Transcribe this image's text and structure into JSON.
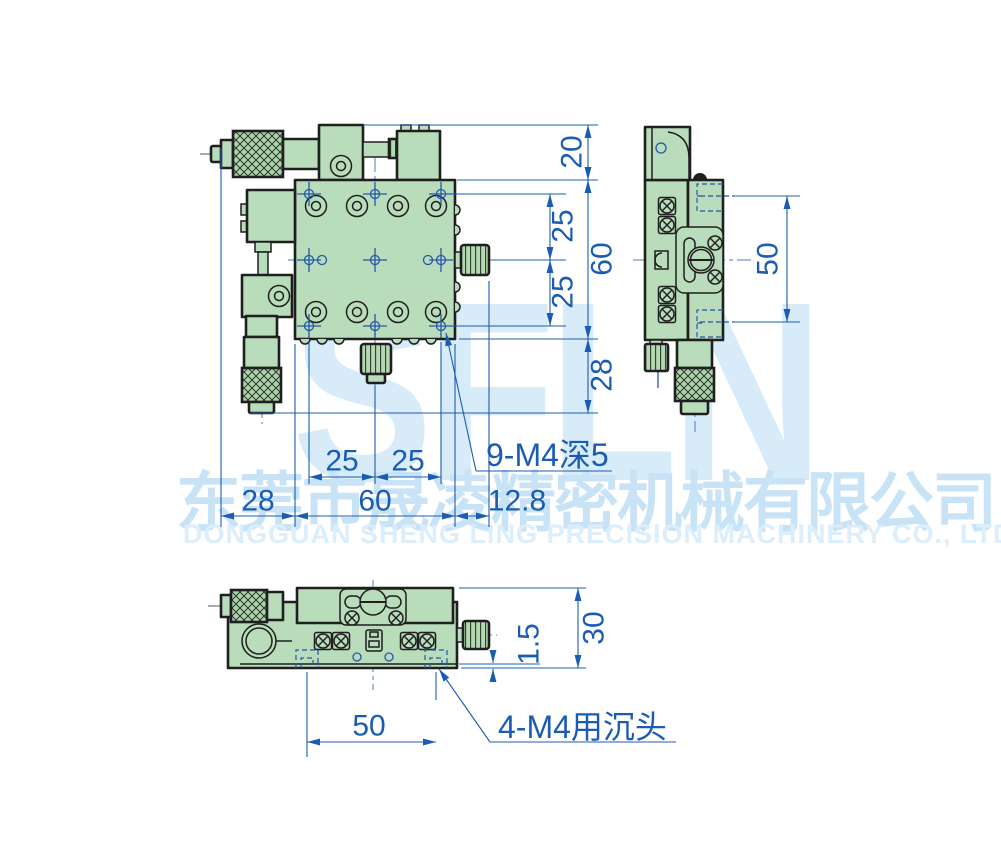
{
  "watermark": {
    "brand": "SFLN",
    "company_cn": "东莞市晟凌精密机械有限公司",
    "company_en": "DONGGUAN SHENG LING PRECISION MACHINERY CO., LTD."
  },
  "dimensions": {
    "front": {
      "top_block_height": "20",
      "hole_pitch_upper": "25",
      "body_height": "60",
      "hole_pitch_lower": "25",
      "base_drop": "28",
      "hole_pitch_left": "25",
      "hole_pitch_right": "25",
      "left_overhang": "28",
      "body_width": "60",
      "knob_overhang": "12.8",
      "tapped_holes_callout": "9-M4深5"
    },
    "side": {
      "platform_hole_span": "50"
    },
    "bottom": {
      "countersink_span": "50",
      "base_lip": "1.5",
      "overall_height": "30",
      "countersink_callout": "4-M4用沉头"
    }
  },
  "colors": {
    "part_fill_green": "#b9dcba",
    "outline_dark": "#1f1f1f",
    "dimension_blue": "#1b5cb3",
    "centerline_blue": "#4a7dc4",
    "watermark_light_blue": "#d7ebf9"
  }
}
